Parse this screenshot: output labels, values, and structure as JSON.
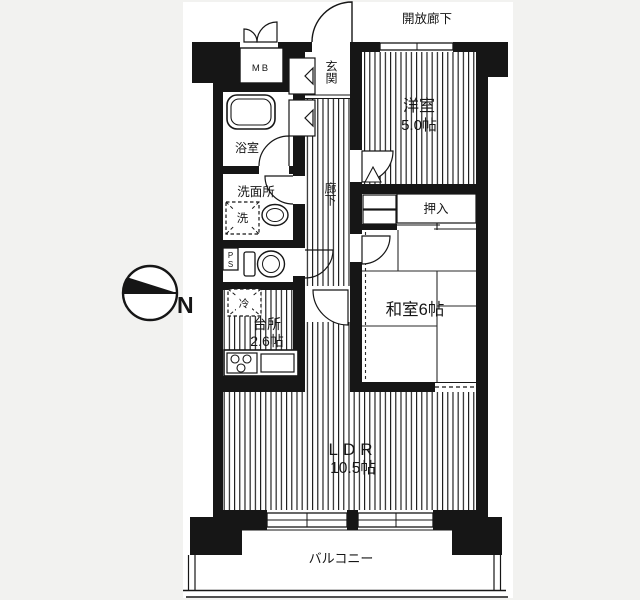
{
  "colors": {
    "background": "#f2f2f0",
    "paper": "#ffffff",
    "ink": "#161616"
  },
  "compass": {
    "north_label": "N"
  },
  "plan": {
    "open_corridor": {
      "label": "開放廊下"
    },
    "entrance": {
      "label": "玄関"
    },
    "meter_box": {
      "label": "MB"
    },
    "western_room": {
      "name": "洋室",
      "size": "5.0帖"
    },
    "bathroom": {
      "name": "浴室"
    },
    "washroom": {
      "name": "洗面所",
      "washer": "洗"
    },
    "pipe_space": {
      "label": "PS"
    },
    "corridor": {
      "label": "廊下"
    },
    "closet": {
      "label": "押入"
    },
    "japanese_room": {
      "name": "和室6帖"
    },
    "kitchen": {
      "name": "台所",
      "size": "2.6帖",
      "fridge": "冷"
    },
    "living": {
      "name": "LDR",
      "size": "10.5帖"
    },
    "balcony": {
      "label": "バルコニー"
    }
  }
}
